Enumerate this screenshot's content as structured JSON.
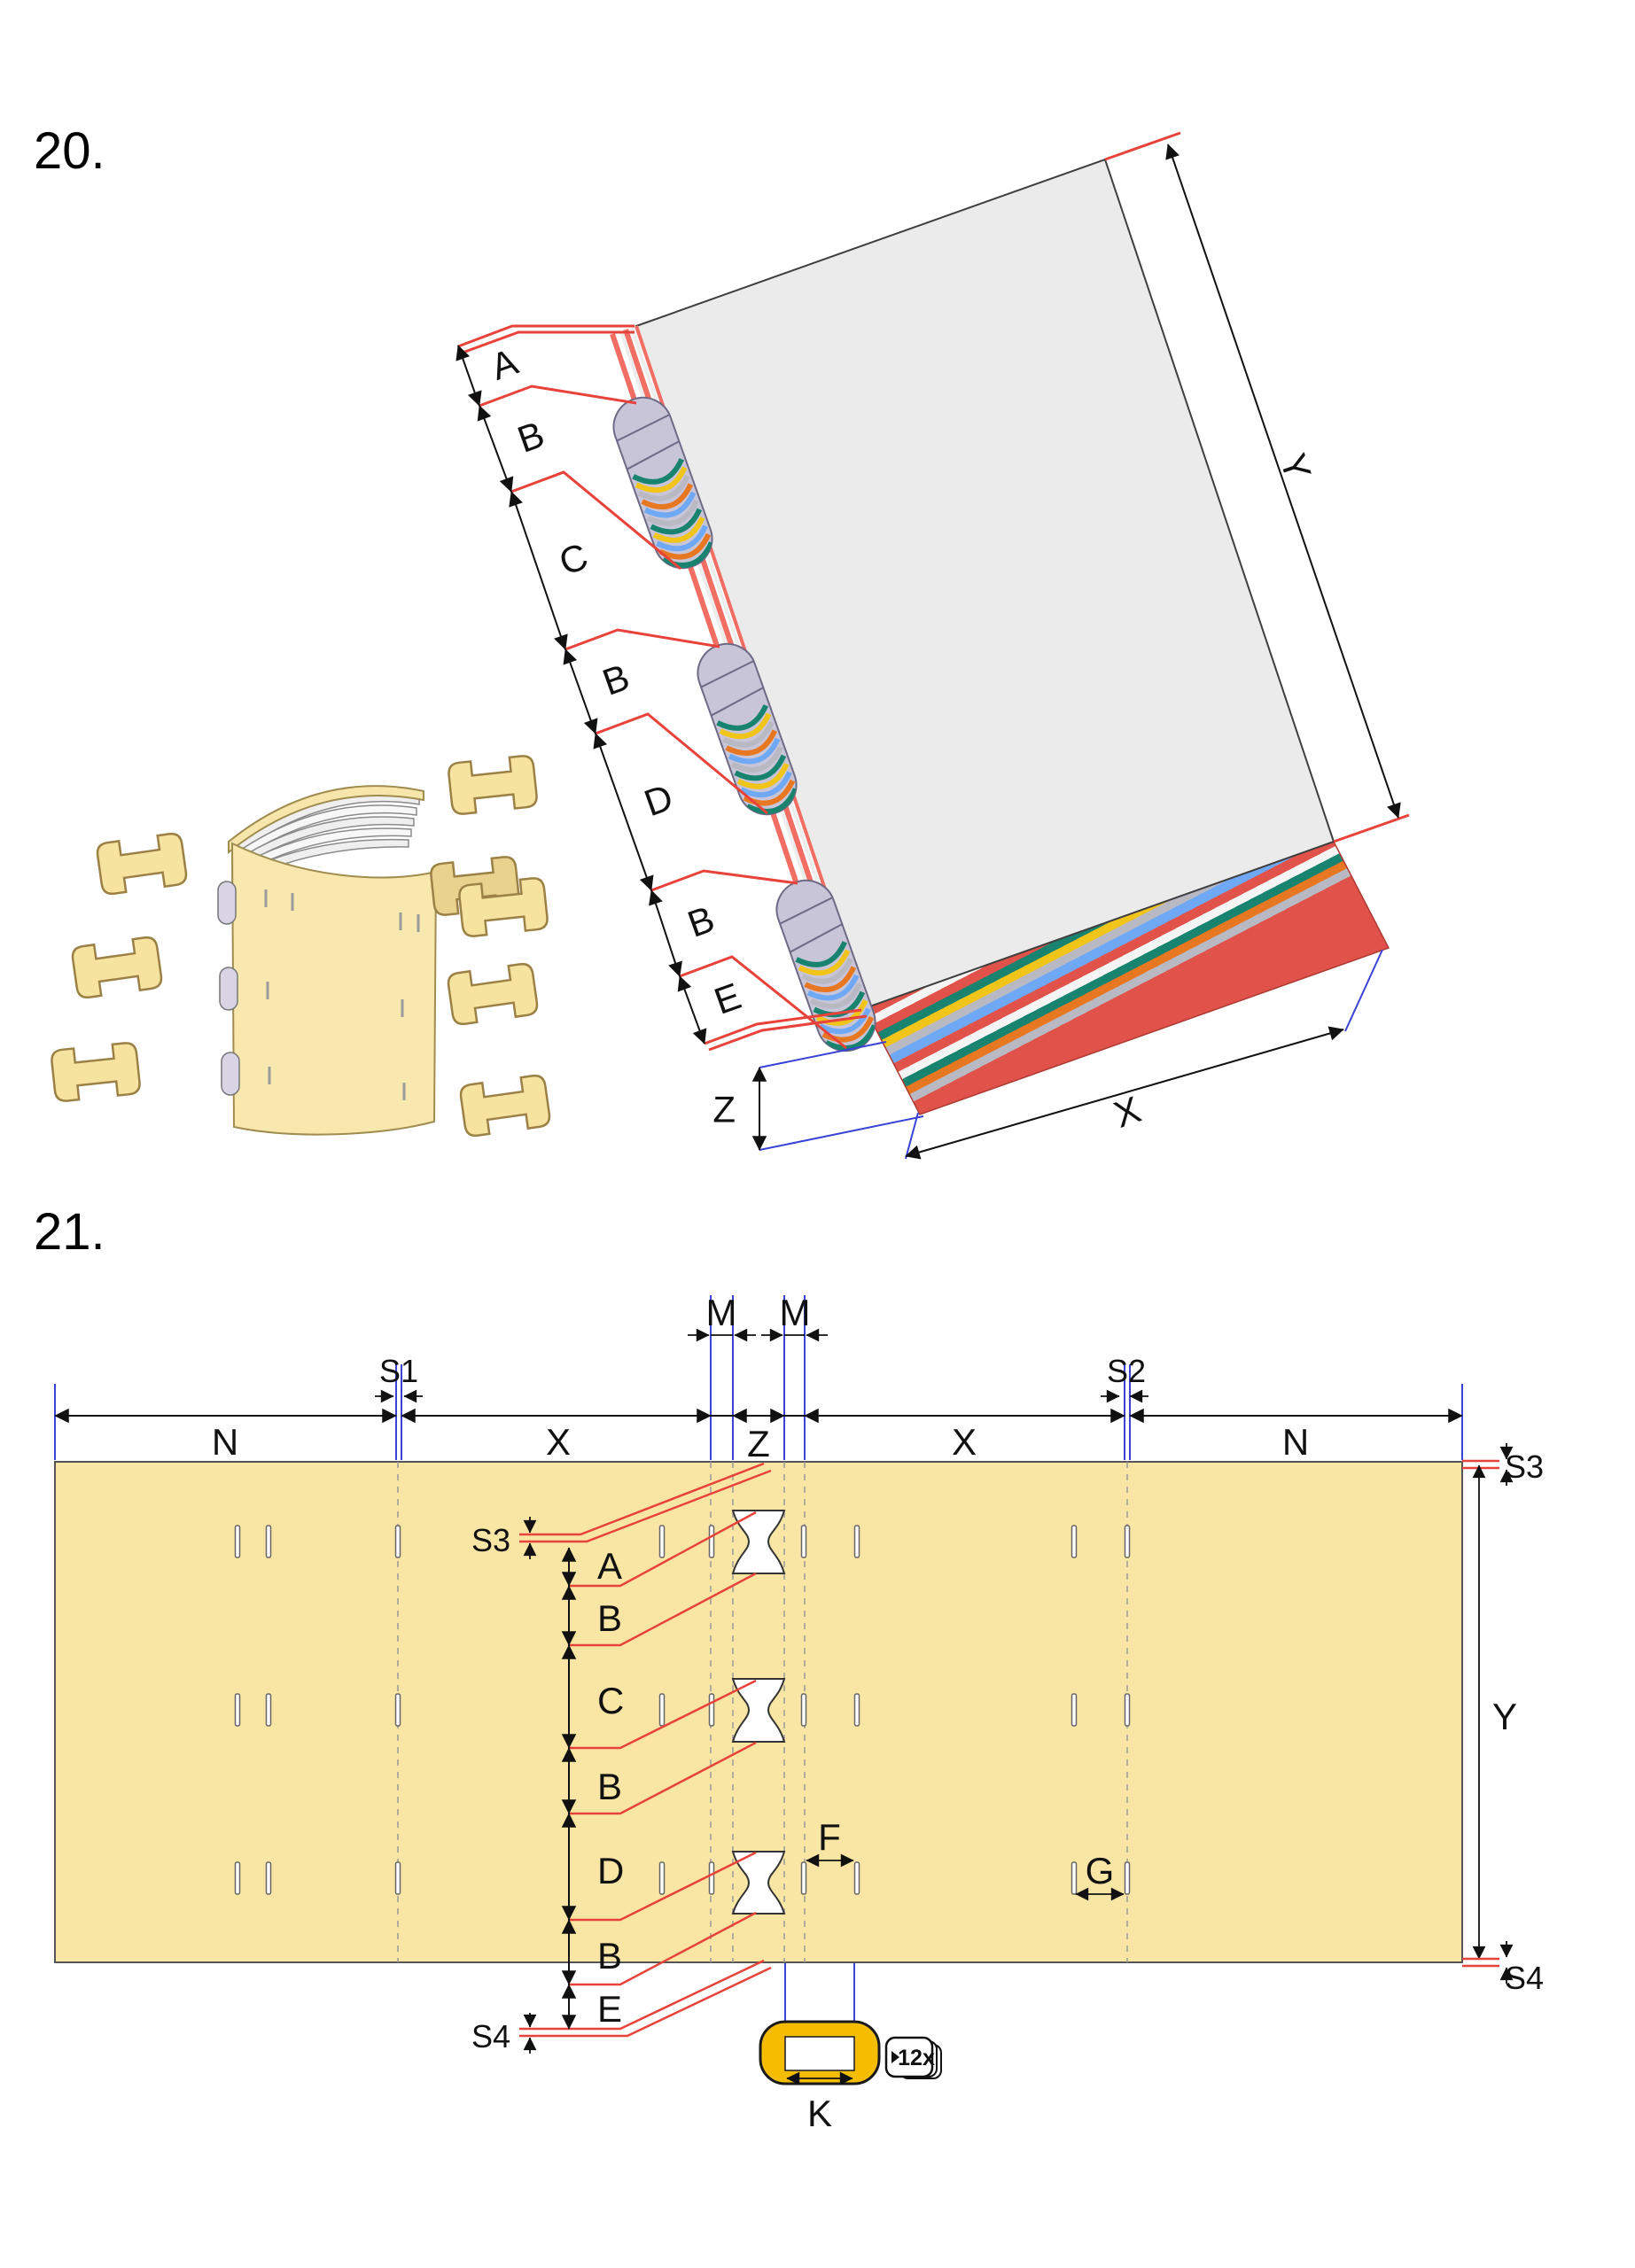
{
  "page": {
    "title20": "20.",
    "title21": "21."
  },
  "fig20": {
    "chain_labels": [
      "A",
      "B",
      "C",
      "B",
      "D",
      "B",
      "E"
    ],
    "dims": {
      "y": "Y",
      "x": "X",
      "z": "Z"
    }
  },
  "fig21": {
    "top": {
      "n_left": "N",
      "x_left": "X",
      "z": "Z",
      "x_right": "X",
      "n_right": "N",
      "m_left": "M",
      "m_right": "M",
      "s1": "S1",
      "s2": "S2"
    },
    "right": {
      "s3": "S3",
      "y": "Y",
      "s4": "S4"
    },
    "chain": {
      "s3": "S3",
      "labels": [
        "A",
        "B",
        "C",
        "B",
        "D",
        "B",
        "E"
      ],
      "s4": "S4"
    },
    "details": {
      "f": "F",
      "g": "G",
      "k": "K",
      "badge": "12x"
    }
  },
  "colors": {
    "cover_yellow": "#FAE6A4",
    "toggle_gold": "#F5BD02",
    "leader_red": "#E8433A",
    "guide_blue": "#3A43D6",
    "cover_gray": "#EBEBEB",
    "signature_lavender": "#C9C5D8",
    "page_teal": "#18836E",
    "page_yellow": "#F0C419",
    "page_orange": "#E87722",
    "page_blue": "#6FA8F5",
    "spine_red": "#F26D62"
  }
}
